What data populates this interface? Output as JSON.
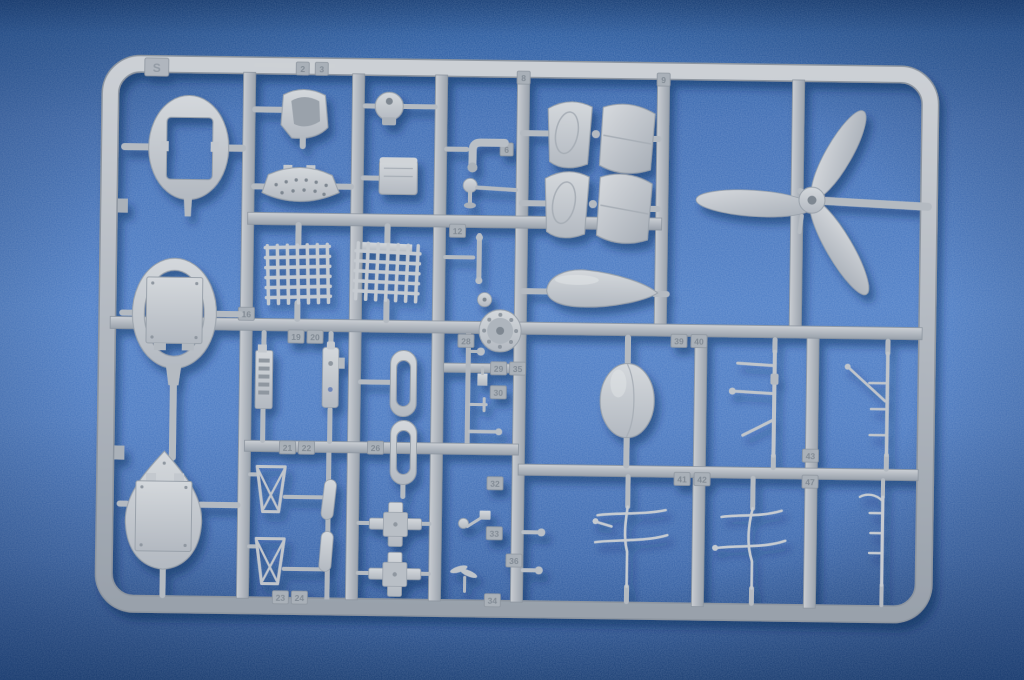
{
  "scene": {
    "description": "Photograph of an injection-molded plastic model kit sprue (parts tree) lying on a mottled blue background",
    "subject": "model-kit-sprue-photo"
  },
  "sprue": {
    "letter": "S",
    "material": "gray styrene plastic",
    "plastic_color": "#b6bcc4",
    "plastic_highlight": "#d6dade",
    "plastic_shadow": "#8e96a0"
  },
  "background": {
    "base_color": "#4678be",
    "edge_color": "#1c4480",
    "shadow_color": "#0a2450"
  },
  "part_tags": [
    {
      "label": "2",
      "x": 299,
      "y": 72
    },
    {
      "label": "3",
      "x": 318,
      "y": 72
    },
    {
      "label": "8",
      "x": 520,
      "y": 78
    },
    {
      "label": "9",
      "x": 660,
      "y": 78
    },
    {
      "label": "6",
      "x": 504,
      "y": 150
    },
    {
      "label": "12",
      "x": 456,
      "y": 232
    },
    {
      "label": "16",
      "x": 246,
      "y": 318
    },
    {
      "label": "19",
      "x": 296,
      "y": 340
    },
    {
      "label": "20",
      "x": 315,
      "y": 340
    },
    {
      "label": "28",
      "x": 466,
      "y": 342
    },
    {
      "label": "29",
      "x": 499,
      "y": 369
    },
    {
      "label": "35",
      "x": 518,
      "y": 369
    },
    {
      "label": "30",
      "x": 499,
      "y": 393
    },
    {
      "label": "39",
      "x": 679,
      "y": 339
    },
    {
      "label": "40",
      "x": 699,
      "y": 339
    },
    {
      "label": "21",
      "x": 289,
      "y": 451
    },
    {
      "label": "22",
      "x": 308,
      "y": 451
    },
    {
      "label": "26",
      "x": 377,
      "y": 450
    },
    {
      "label": "41",
      "x": 684,
      "y": 477
    },
    {
      "label": "42",
      "x": 704,
      "y": 477
    },
    {
      "label": "43",
      "x": 812,
      "y": 452
    },
    {
      "label": "47",
      "x": 812,
      "y": 478
    },
    {
      "label": "32",
      "x": 497,
      "y": 484
    },
    {
      "label": "33",
      "x": 497,
      "y": 534
    },
    {
      "label": "36",
      "x": 517,
      "y": 561
    },
    {
      "label": "34",
      "x": 496,
      "y": 601
    },
    {
      "label": "23",
      "x": 284,
      "y": 601
    },
    {
      "label": "24",
      "x": 303,
      "y": 601
    }
  ],
  "parts_inventory": [
    {
      "name": "cockpit-frame-former",
      "count": 1
    },
    {
      "name": "pilot-seat",
      "count": 1
    },
    {
      "name": "perforated-floor-plate",
      "count": 1
    },
    {
      "name": "ball-mount",
      "count": 1
    },
    {
      "name": "equipment-box",
      "count": 1
    },
    {
      "name": "elbow-pipe",
      "count": 1
    },
    {
      "name": "cowl-flap-panel",
      "count": 4
    },
    {
      "name": "three-blade-propeller",
      "count": 1
    },
    {
      "name": "radiator-mesh-screen",
      "count": 2
    },
    {
      "name": "drop-tank",
      "count": 1
    },
    {
      "name": "engine-crankcase-front",
      "count": 1
    },
    {
      "name": "oval-bulkhead-with-plate",
      "count": 1
    },
    {
      "name": "teardrop-bulkhead-with-plate",
      "count": 1
    },
    {
      "name": "instrument-panel",
      "count": 2
    },
    {
      "name": "oblong-canopy-frame",
      "count": 2
    },
    {
      "name": "egg-shaped-tank",
      "count": 1
    },
    {
      "name": "strut-and-line-set",
      "count": 4
    },
    {
      "name": "support-trestle",
      "count": 2
    },
    {
      "name": "small-cylinder",
      "count": 2
    },
    {
      "name": "cross-mount",
      "count": 2
    },
    {
      "name": "antenna-mast",
      "count": 1
    },
    {
      "name": "small-detail-part",
      "count": 10
    }
  ]
}
